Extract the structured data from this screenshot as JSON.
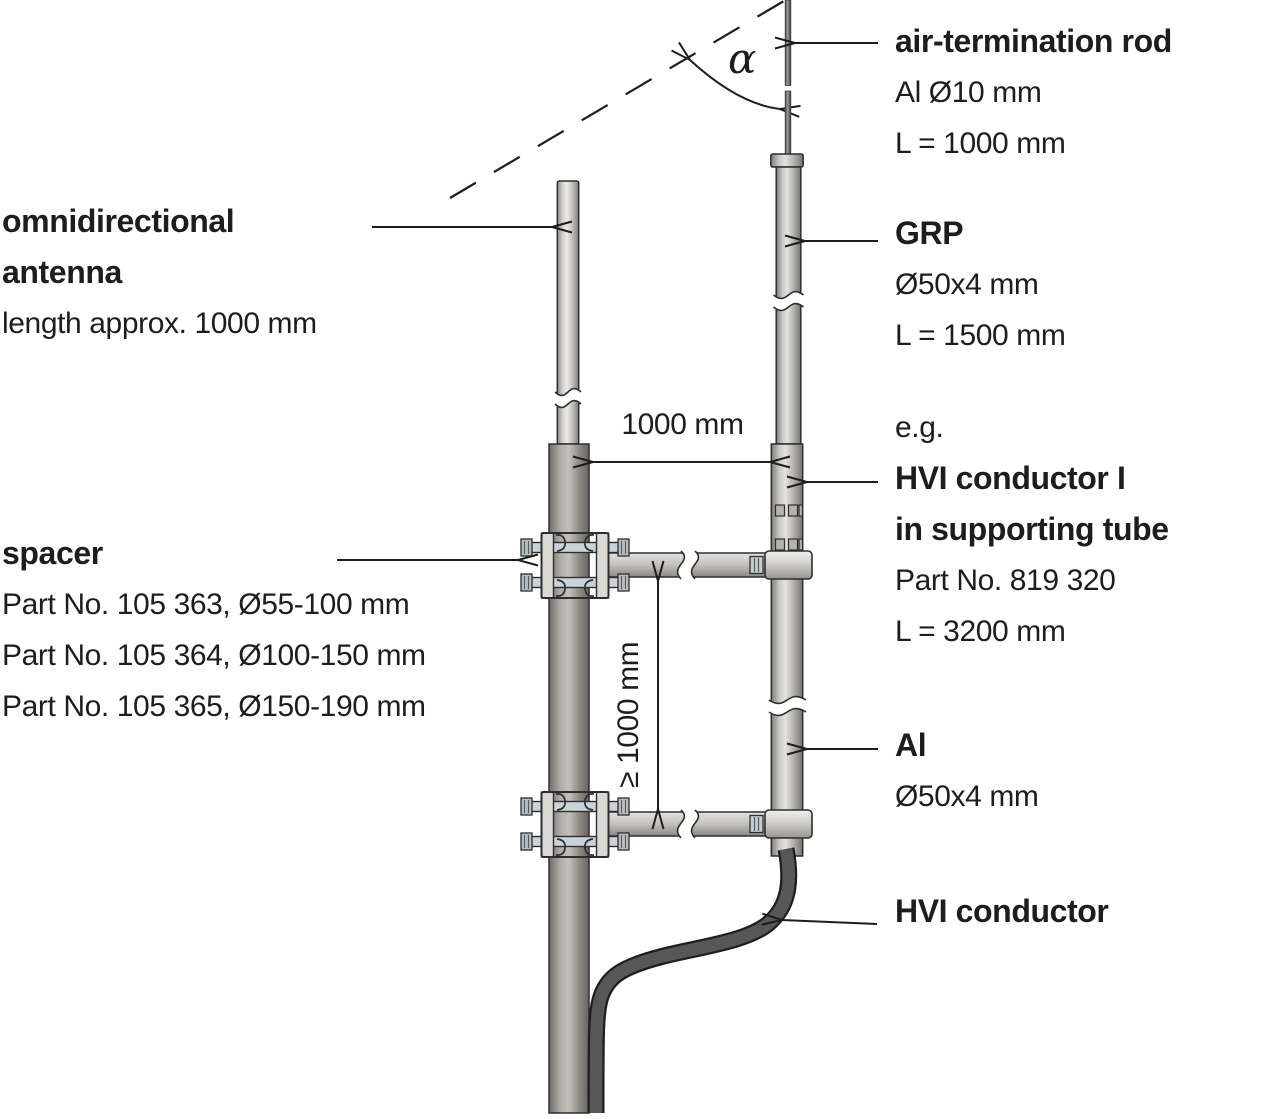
{
  "labels": {
    "antenna": {
      "title_line1": "omnidirectional",
      "title_line2": "antenna",
      "subtitle": "length approx. 1000 mm"
    },
    "spacer": {
      "title": "spacer",
      "parts": [
        "Part No. 105 363, Ø55-100 mm",
        "Part No. 105 364, Ø100-150 mm",
        "Part No. 105 365, Ø150-190 mm"
      ]
    },
    "air_termination_rod": {
      "title": "air-termination rod",
      "material": "Al Ø10 mm",
      "length": "L = 1000 mm"
    },
    "grp": {
      "title": "GRP",
      "diameter": "Ø50x4 mm",
      "length": "L = 1500 mm"
    },
    "hvi_conductor_tube": {
      "prefix": "e.g.",
      "title_line1": "HVI conductor I",
      "title_line2": "in supporting tube",
      "part": "Part No. 819 320",
      "length": "L = 3200 mm"
    },
    "al_tube": {
      "title": "Al",
      "diameter": "Ø50x4 mm"
    },
    "hvi_conductor": {
      "title": "HVI conductor"
    },
    "dimensions": {
      "horizontal": "1000 mm",
      "vertical": "≥ 1000 mm",
      "angle": "α"
    }
  },
  "colors": {
    "text": "#1d1d1b",
    "line": "#1d1d1b",
    "tube_highlight": "#ebebea",
    "tube_mid": "#c6c4c1",
    "tube_edge": "#7d7a76",
    "cable_dark": "#1e1e1e",
    "cable_mid": "#575757",
    "background": "#ffffff"
  }
}
